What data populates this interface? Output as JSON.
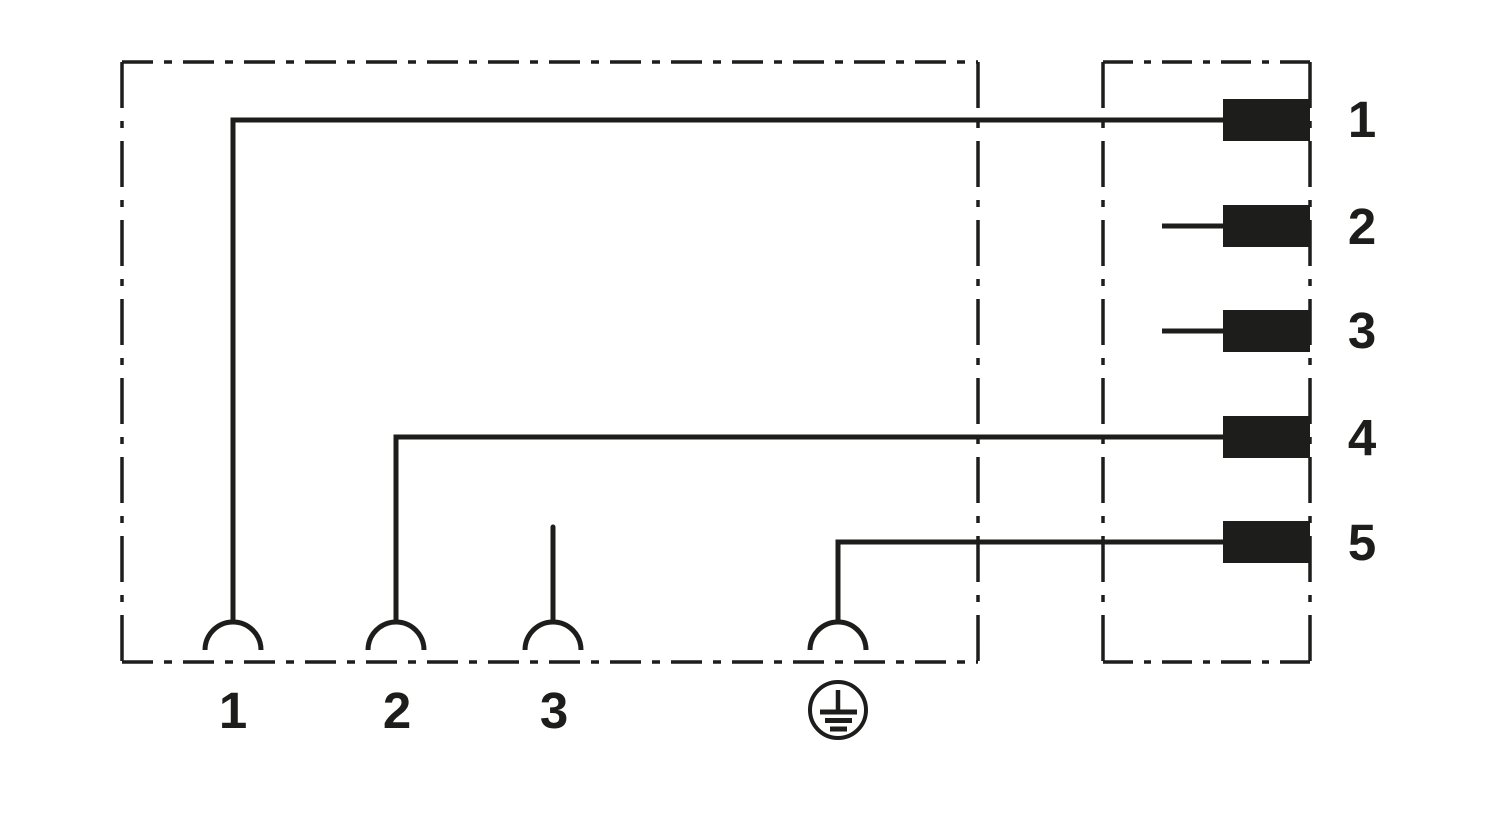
{
  "diagram": {
    "title": "Valve connector contact assignment wiring diagram",
    "colors": {
      "ink": "#1d1d1b",
      "background": "#ffffff"
    },
    "connector_pins": [
      {
        "id": "pin-1",
        "label": "1"
      },
      {
        "id": "pin-2",
        "label": "2"
      },
      {
        "id": "pin-3",
        "label": "3"
      },
      {
        "id": "pin-4",
        "label": "4"
      },
      {
        "id": "pin-5",
        "label": "5"
      }
    ],
    "socket_contacts": [
      {
        "id": "contact-1",
        "label": "1"
      },
      {
        "id": "contact-2",
        "label": "2"
      },
      {
        "id": "contact-3",
        "label": "3"
      },
      {
        "id": "contact-pe",
        "label": "",
        "icon": "protective-earth-icon"
      }
    ],
    "connections": [
      {
        "from_contact": "contact-1",
        "to_pin": "pin-1"
      },
      {
        "from_contact": "contact-2",
        "to_pin": "pin-4"
      },
      {
        "from_contact": "contact-pe",
        "to_pin": "pin-5"
      }
    ]
  }
}
